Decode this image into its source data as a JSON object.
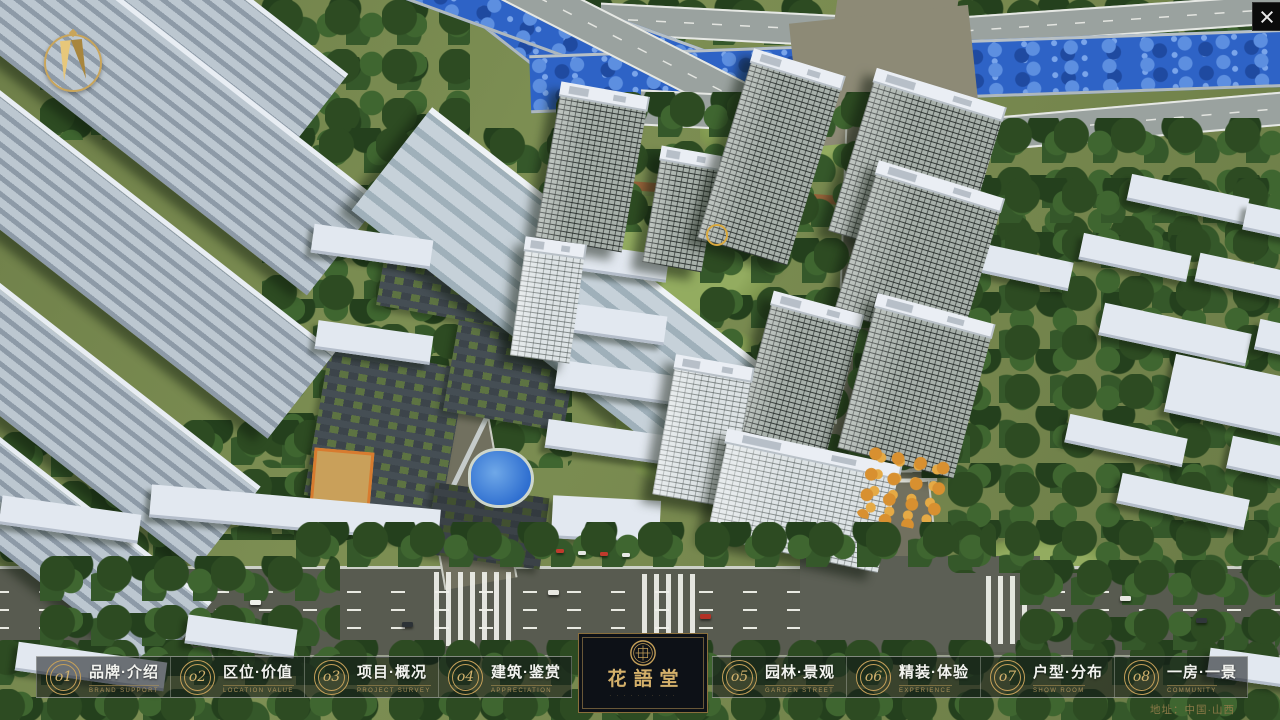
{
  "nav": {
    "items": [
      {
        "num": "o1",
        "zh": "品牌·介绍",
        "en": "BRAND SUPPORT"
      },
      {
        "num": "o2",
        "zh": "区位·价值",
        "en": "LOCATION VALUE"
      },
      {
        "num": "o3",
        "zh": "项目·概况",
        "en": "PROJECT SURVEY"
      },
      {
        "num": "o4",
        "zh": "建筑·鉴赏",
        "en": "APPRECIATION"
      },
      {
        "num": "o5",
        "zh": "园林·景观",
        "en": "GARDEN STREET"
      },
      {
        "num": "o6",
        "zh": "精装·体验",
        "en": "EXPERIENCE"
      },
      {
        "num": "o7",
        "zh": "户型·分布",
        "en": "SHOW ROOM"
      },
      {
        "num": "o8",
        "zh": "一房·一景",
        "en": "COMMUNITY"
      }
    ]
  },
  "logo": {
    "title": "花語堂",
    "subtext": "· · · · · · · · · ·"
  },
  "footer": {
    "address": "地址：中国·山西"
  },
  "palette": {
    "gold": "#c5a059",
    "river_blue": "#2e63c6",
    "road_gray": "#585b50",
    "tree_green": "#2d4b22",
    "panel_dark": "#0d1117"
  }
}
